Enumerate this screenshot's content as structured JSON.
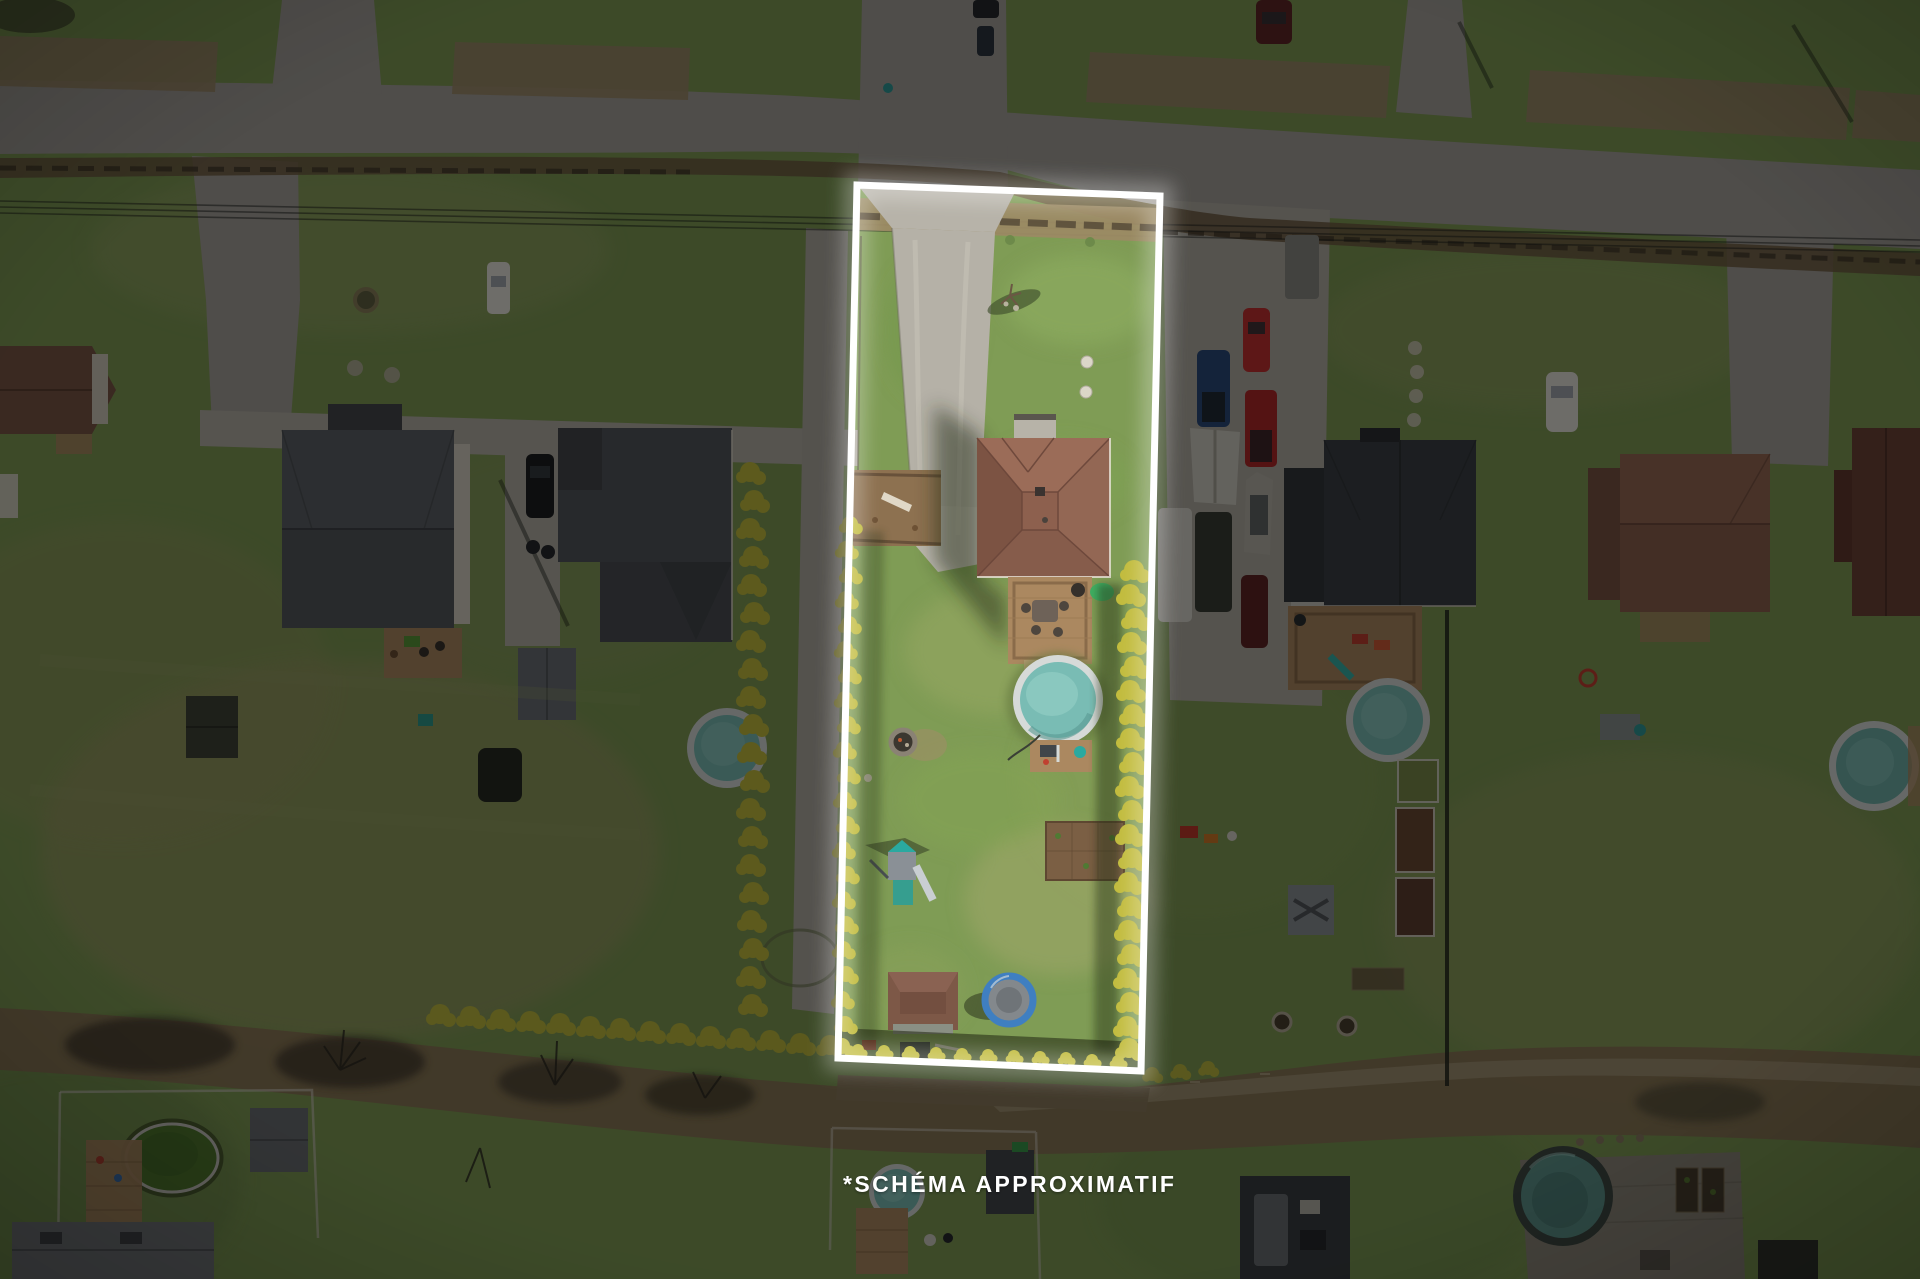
{
  "caption": {
    "text": "*SCHÉMA APPROXIMATIF"
  },
  "scene": {
    "type": "aerial-drone-photo",
    "subject": "residential lot highlighted with a white approximate boundary outline, surroundings dimmed",
    "landmarks": [
      "street-intersection",
      "gravel-driveway",
      "main-house-brown-roof",
      "wood-deck",
      "above-ground-pool",
      "fire-pit",
      "play-structure",
      "garden-plot",
      "garden-shed",
      "trampoline",
      "cedar-hedge",
      "neighbor-houses",
      "parked-vehicles",
      "neighbor-pools"
    ]
  },
  "colors": {
    "grass": "#7f9c55",
    "grass-dry": "#a3a872",
    "road": "#a5a19b",
    "gravel": "#b5b1a7",
    "brush": "#9c8a68",
    "brush-dark": "#6f5c42",
    "roof-gray": "#54585d",
    "roof-dark": "#3c4045",
    "roof-brown": "#8d604e",
    "wood": "#ab8860",
    "pool-rim": "#d6dad8",
    "pool-water": "#79bcb4",
    "hedge": "#c2bc3e",
    "outline": "#ffffff",
    "dim": "rgba(0,0,0,0.52)",
    "caption": "#ffffff"
  }
}
